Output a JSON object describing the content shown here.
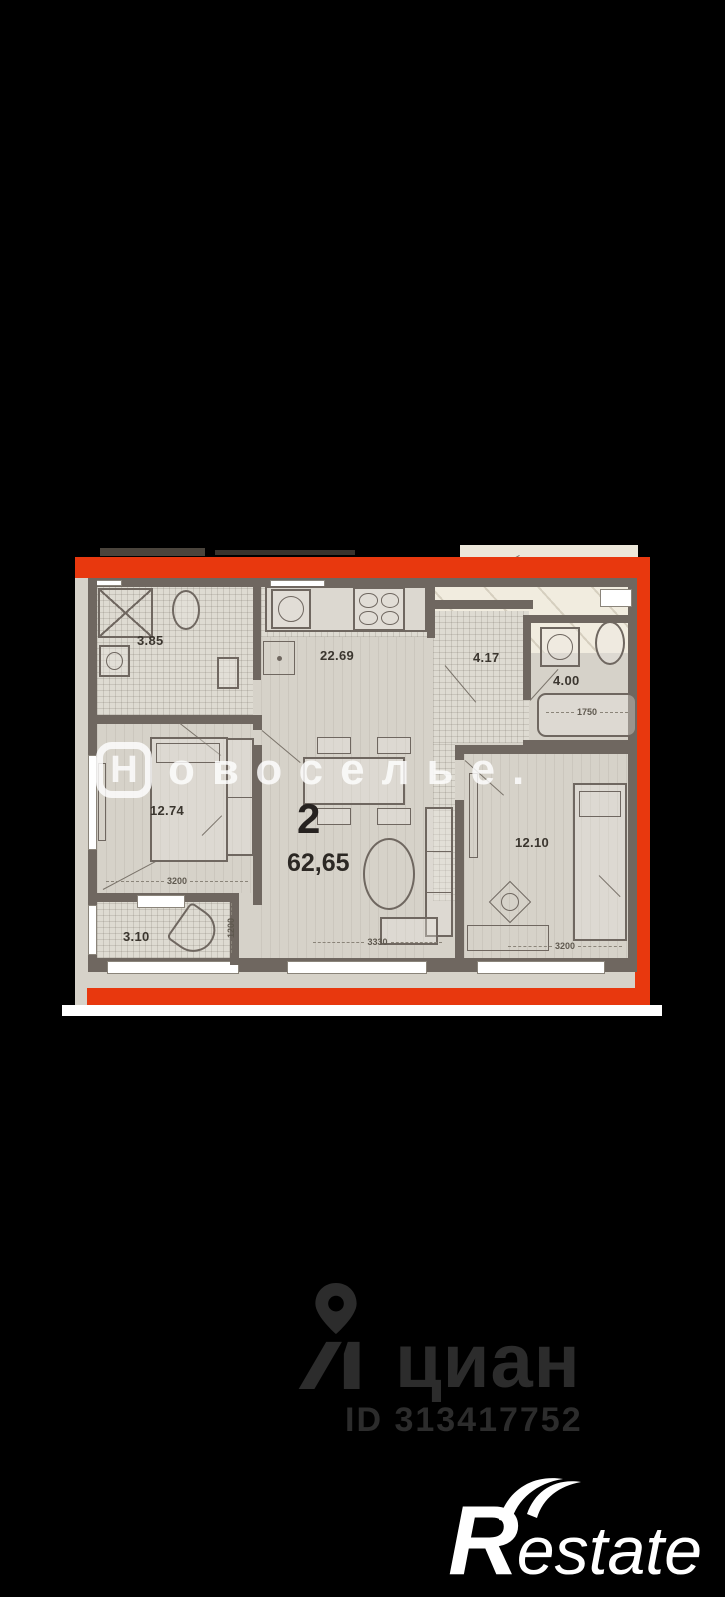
{
  "background_color": "#000000",
  "plan": {
    "frame_color": "#e8380e",
    "floor_color": "#d6d2c9",
    "wall_color": "#6f6760",
    "apartment": {
      "rooms_count": "2",
      "total_area": "62,65"
    },
    "rooms": [
      {
        "key": "bathroom_small",
        "area": "3.85"
      },
      {
        "key": "kitchen_living",
        "area": "22.69"
      },
      {
        "key": "hallway",
        "area": "4.17"
      },
      {
        "key": "bathroom",
        "area": "4.00"
      },
      {
        "key": "bedroom_left",
        "area": "12.74"
      },
      {
        "key": "bedroom_right",
        "area": "12.10"
      },
      {
        "key": "balcony",
        "area": "3.10"
      }
    ],
    "dimensions": {
      "bedroom_left_width": "3200",
      "balcony_depth": "1200",
      "living_width": "3330",
      "bedroom_right_width": "3200",
      "bathtub_length": "1750"
    }
  },
  "watermarks": {
    "novoselye": {
      "first_letter": "Н",
      "rest_letters": "овоселье."
    },
    "cian": {
      "name": "циан",
      "listing_id": "ID 313417752"
    },
    "restate": {
      "initial": "R",
      "rest": "estate"
    }
  }
}
